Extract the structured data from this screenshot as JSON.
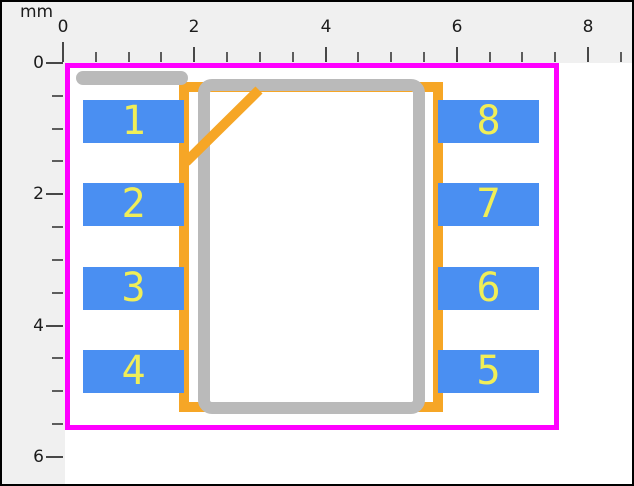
{
  "unit": "mm",
  "ruler_top": {
    "labels": [
      "0",
      "2",
      "4",
      "6",
      "8"
    ]
  },
  "ruler_left": {
    "labels": [
      "0",
      "2",
      "4",
      "6"
    ]
  },
  "pads": {
    "left": [
      "1",
      "2",
      "3",
      "4"
    ],
    "right": [
      "8",
      "7",
      "6",
      "5"
    ]
  },
  "colors": {
    "panel_bg": "#f0f0f0",
    "canvas_bg": "#ffffff",
    "courtyard": "#ff00ff",
    "silkscreen": "#f6a626",
    "body_outline": "#bababa",
    "pad_fill": "#4a8ff2",
    "pad_number": "#f0ee58"
  }
}
